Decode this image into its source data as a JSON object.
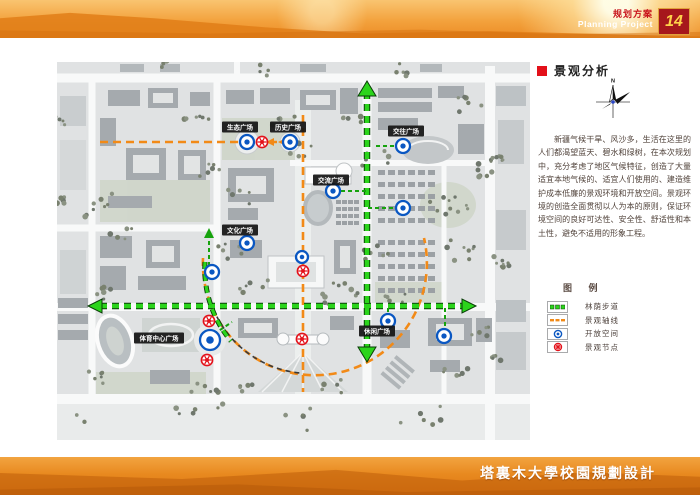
{
  "header": {
    "title_zh": "规划方案",
    "title_en": "Planning Project",
    "page_number": "14"
  },
  "section": {
    "title": "景观分析"
  },
  "compass": {
    "label": "N"
  },
  "description": "新疆气候干旱、风沙多，生活在这里的人们都渴望蓝天、碧水和绿树，在本次规划中，充分考虑了地区气候特征，创造了大量适宜本地气候的、适宜人们使用的、建造维护成本低廉的景观环境和开放空间。景观环境的创造全面贯彻以人为本的原则，保证环境空间的良好可达性、安全性、舒适性和本土性，避免不适用的形象工程。",
  "legend": {
    "title": "图 例",
    "items": [
      {
        "label": "林荫步道",
        "type": "green-dash"
      },
      {
        "label": "景观轴线",
        "type": "orange-dash"
      },
      {
        "label": "开放空间",
        "type": "blue-node"
      },
      {
        "label": "景观节点",
        "type": "red-node"
      }
    ]
  },
  "map": {
    "plazas": [
      {
        "name": "生态广场",
        "x": 240,
        "y": 127
      },
      {
        "name": "历史广场",
        "x": 288,
        "y": 127
      },
      {
        "name": "交往广场",
        "x": 406,
        "y": 131
      },
      {
        "name": "交流广场",
        "x": 331,
        "y": 180
      },
      {
        "name": "文化广场",
        "x": 240,
        "y": 230
      },
      {
        "name": "体育中心广场",
        "x": 159,
        "y": 338
      },
      {
        "name": "休闲广场",
        "x": 377,
        "y": 331
      }
    ],
    "open_space_nodes": [
      [
        247,
        142,
        7
      ],
      [
        290,
        142,
        7
      ],
      [
        403,
        146,
        7
      ],
      [
        333,
        191,
        7
      ],
      [
        403,
        208,
        7
      ],
      [
        247,
        243,
        7
      ],
      [
        302,
        257,
        6
      ],
      [
        212,
        272,
        7
      ],
      [
        210,
        340,
        10
      ],
      [
        388,
        321,
        7
      ],
      [
        444,
        336,
        7
      ]
    ],
    "landscape_nodes": [
      [
        262,
        142
      ],
      [
        303,
        271
      ],
      [
        302,
        339
      ],
      [
        209,
        321
      ],
      [
        207,
        360
      ]
    ]
  },
  "footer": {
    "title": "塔裏木大學校園規劃設計"
  },
  "colors": {
    "path_green": "#2bd41b",
    "axis_orange": "#f28a17",
    "node_blue": "#0a57c2",
    "node_red": "#e3111a",
    "header_red": "#c8131b",
    "badge_red": "#a6171c"
  }
}
